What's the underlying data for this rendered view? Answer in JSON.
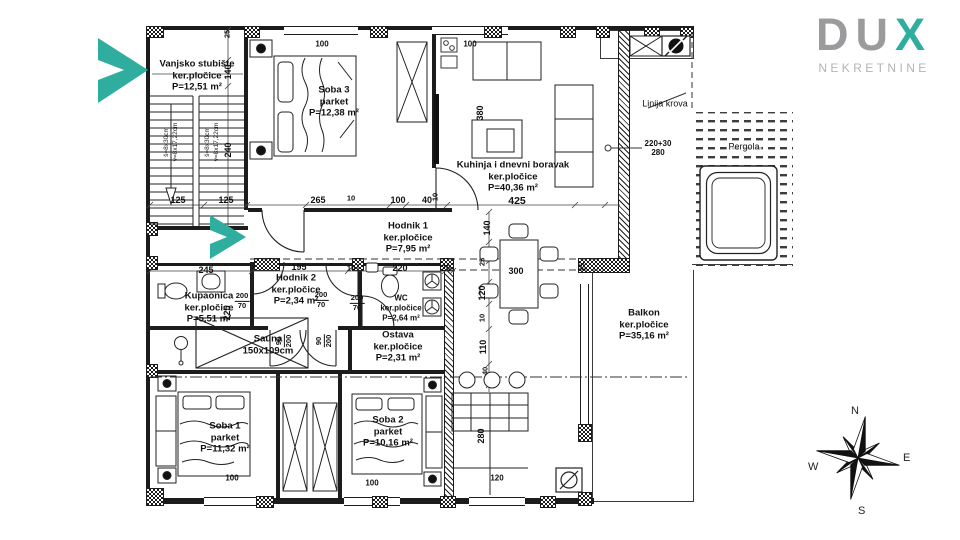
{
  "brand": {
    "letter_d": "D",
    "letter_u": "U",
    "letter_x": "X",
    "subtitle": "NEKRETNINE"
  },
  "colors": {
    "teal": "#2fae9f",
    "logo_gray": "#9b9b9e",
    "line": "#1c1c1c"
  },
  "rooms": [
    {
      "name": "Vanjsko stubište",
      "finish": "ker.pločice",
      "area": "P=12,51 m²"
    },
    {
      "name": "Soba 3",
      "finish": "parket",
      "area": "P=12,38 m²"
    },
    {
      "name": "Kuhinja i dnevni boravak",
      "finish": "ker.pločice",
      "area": "P=40,36 m²"
    },
    {
      "name": "Hodnik 1",
      "finish": "ker.pločice",
      "area": "P=7,95 m²"
    },
    {
      "name": "Kupaonica",
      "finish": "ker.pločice",
      "area": "P=5,51 m²"
    },
    {
      "name": "Hodnik 2",
      "finish": "ker.pločice",
      "area": "P=2,34 m²"
    },
    {
      "name": "WC",
      "finish": "ker.pločice",
      "area": "P=2,64 m²"
    },
    {
      "name": "Sauna",
      "finish": "150x109cm",
      "area": ""
    },
    {
      "name": "Ostava",
      "finish": "ker.pločice",
      "area": "P=2,31 m²"
    },
    {
      "name": "Soba 1",
      "finish": "parket",
      "area": "P=11,32 m²"
    },
    {
      "name": "Soba 2",
      "finish": "parket",
      "area": "P=10,16 m²"
    },
    {
      "name": "Balkon",
      "finish": "ker.pločice",
      "area": "P=35,16 m²"
    }
  ],
  "annotations": {
    "roof_line": "Linija krova",
    "pergola": "Pergola",
    "beam_dim_top": "220+30",
    "beam_dim_bottom": "280"
  },
  "stairs": {
    "run": "š=8x30cm",
    "rise": "v=8x17,22cm"
  },
  "dims_h": [
    "125",
    "125",
    "265",
    "10",
    "100",
    "40",
    "425",
    "245",
    "195",
    "10",
    "220",
    "20",
    "300"
  ],
  "dims_v": [
    "25",
    "140",
    "240",
    "225",
    "380",
    "10",
    "140",
    "25",
    "120",
    "10",
    "110",
    "40",
    "280",
    "25"
  ],
  "openings": [
    "100",
    "100",
    "100",
    "100",
    "120"
  ],
  "doors": {
    "flat": [
      [
        "200",
        "70"
      ],
      [
        "200",
        "70"
      ],
      [
        "200",
        "70"
      ]
    ],
    "rot": [
      [
        "90",
        "200"
      ],
      [
        "90",
        "200"
      ]
    ]
  },
  "compass": {
    "n": "N",
    "e": "E",
    "s": "S",
    "w": "W"
  }
}
